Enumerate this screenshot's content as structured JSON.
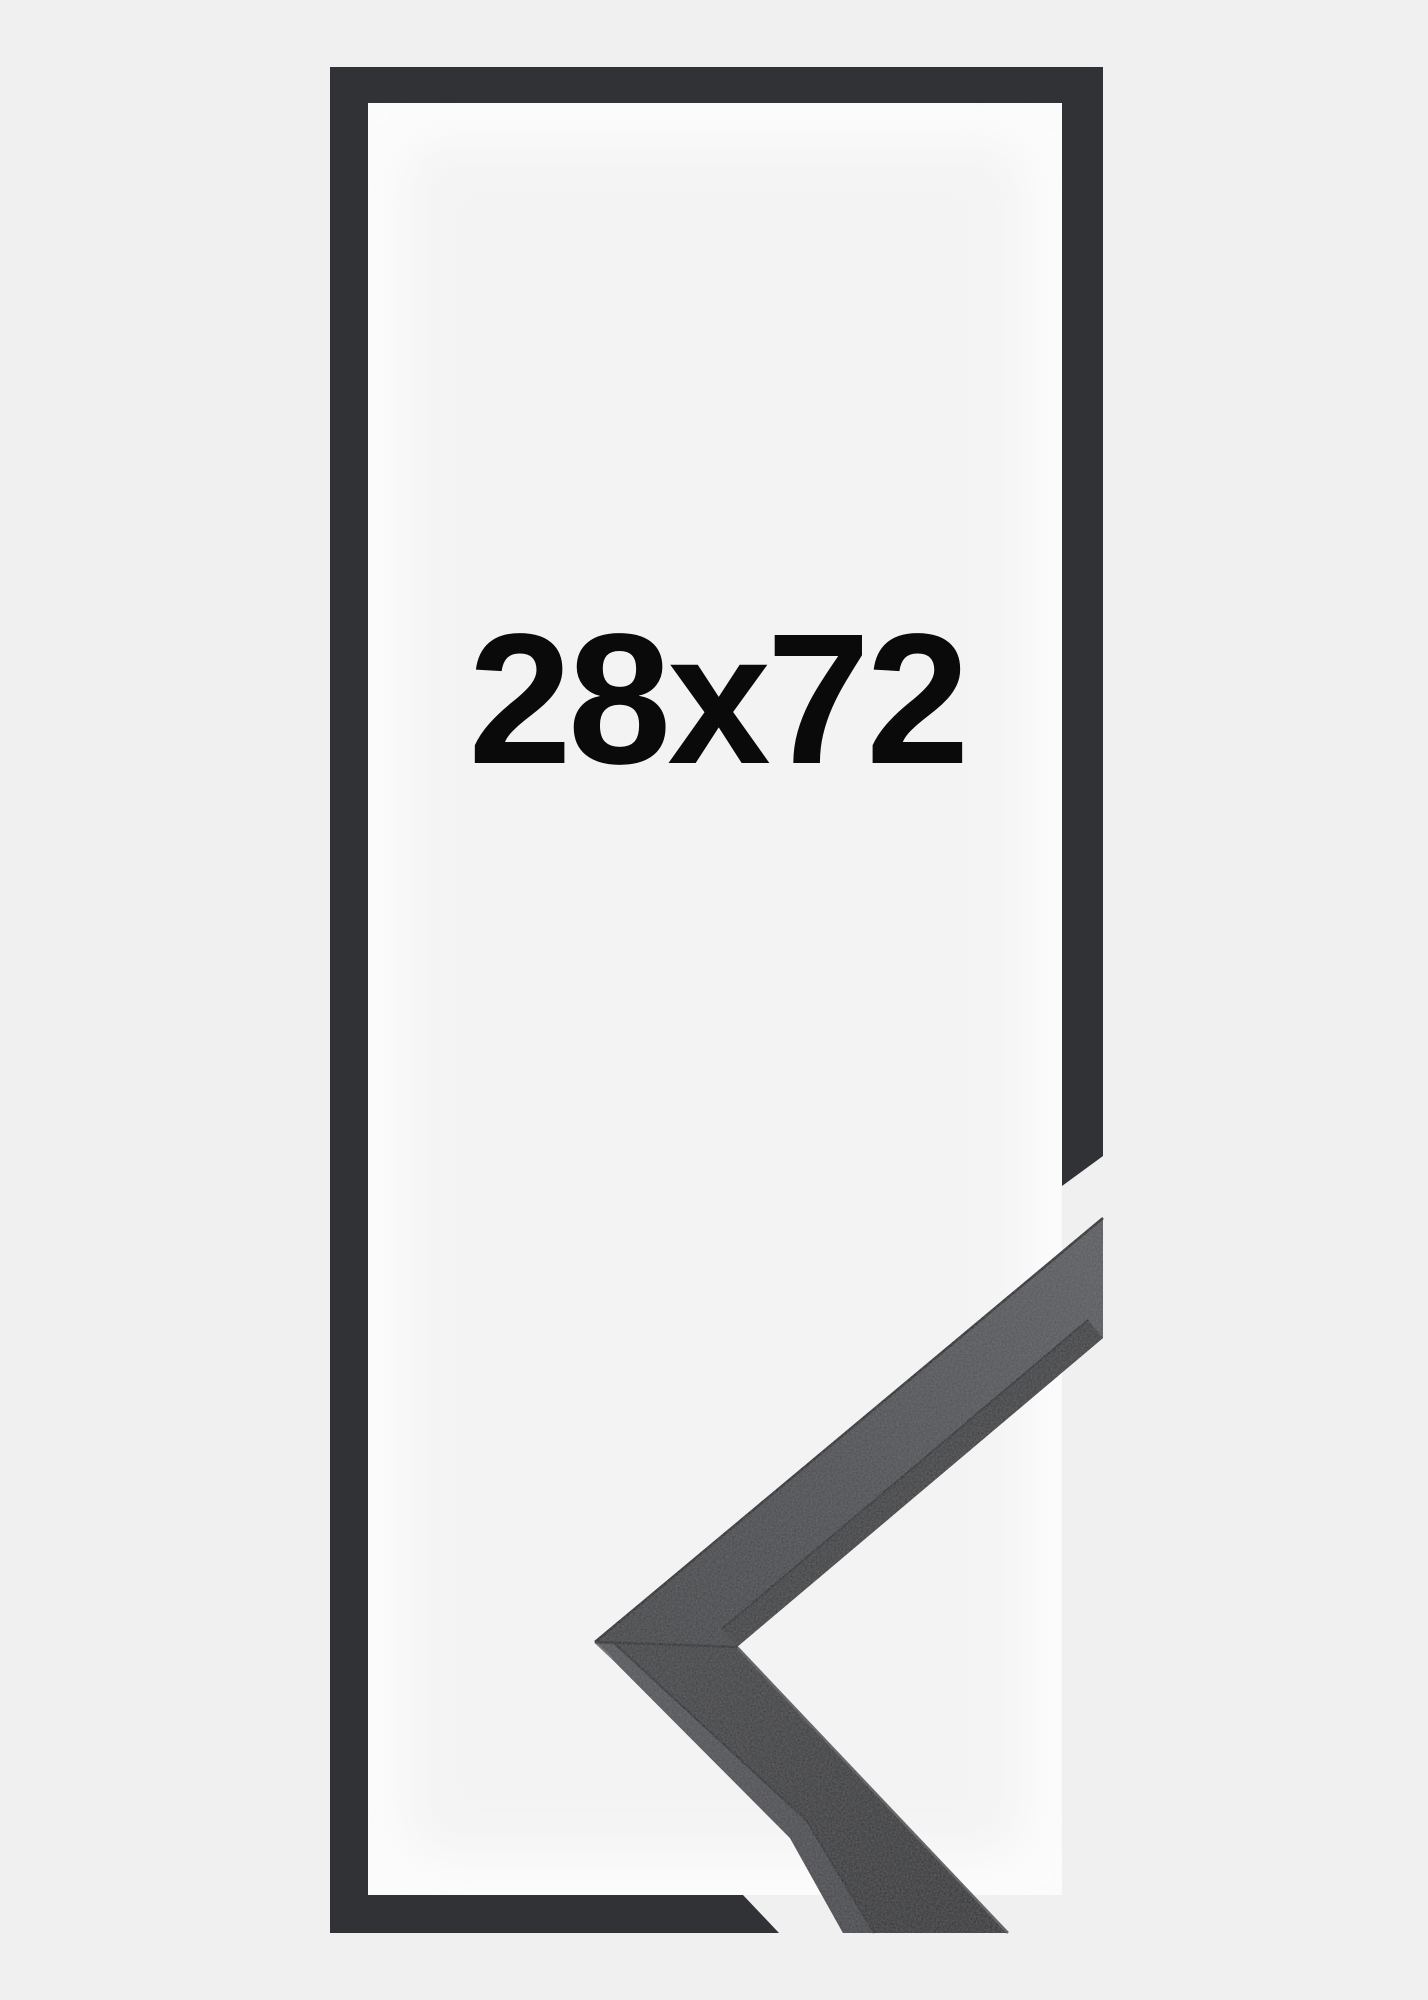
{
  "frame_product": {
    "size_label": "28x72"
  },
  "colors": {
    "background": "#f0f0f1",
    "interior": "#f3f3f4",
    "interior_glow": "#ffffff",
    "frame_graphic": "#303235",
    "label_text": "#0a0a0a",
    "arm_upper_face_light": "#54565a",
    "arm_upper_face_dark": "#3b3c3f",
    "arm_upper_inner_strip": "#37383b",
    "arm_lower_face_light": "#3a3b3e",
    "arm_lower_face_dark": "#2a2b2d",
    "side_face_light": "#505155",
    "side_face_dark": "#404145",
    "edge_dark_line": "#1e1f21",
    "seam_line": "#232427",
    "inner_edge_highlight": "#55565a",
    "arris_highlight": "#6a6b6e"
  }
}
